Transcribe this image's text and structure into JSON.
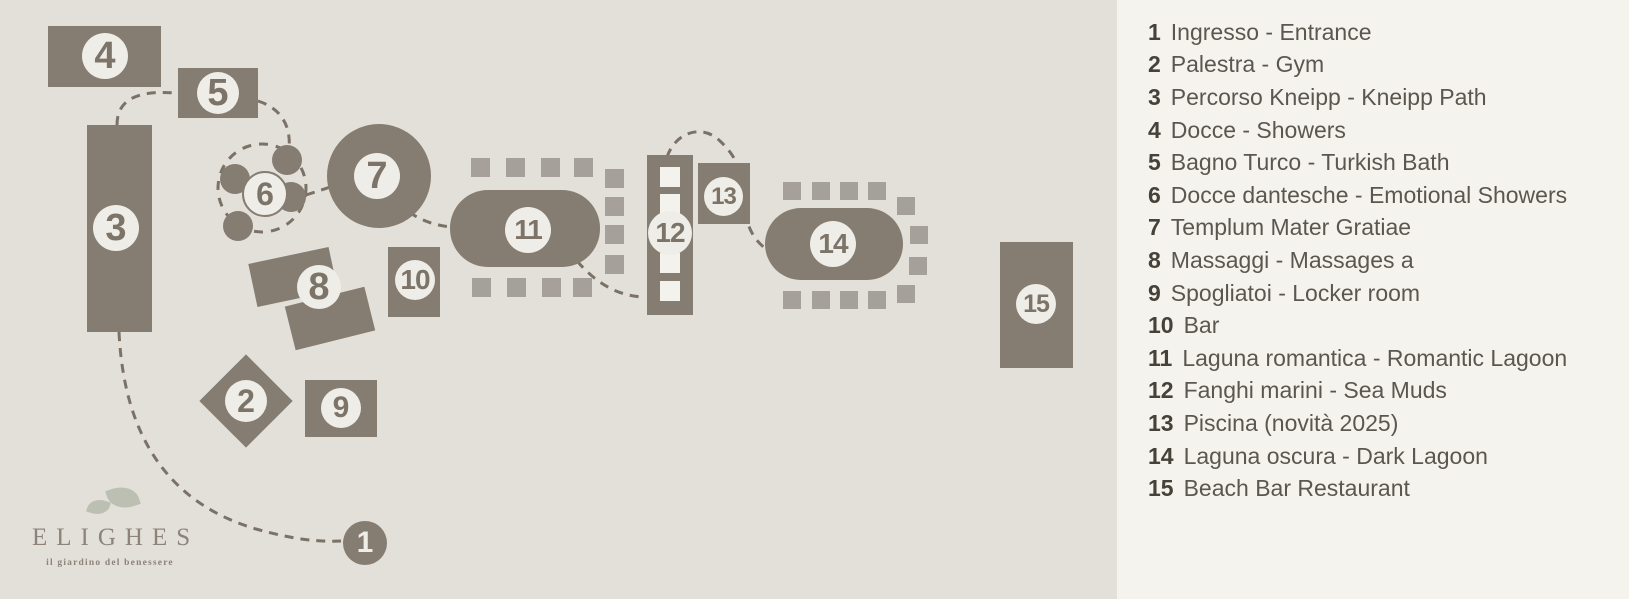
{
  "logo": {
    "brand": "ELIGHES",
    "tagline": "il giardino del benessere"
  },
  "map": {
    "markers": [
      "1",
      "2",
      "3",
      "4",
      "5",
      "6",
      "7",
      "8",
      "9",
      "10",
      "11",
      "12",
      "13",
      "14",
      "15"
    ]
  },
  "legend": {
    "items": [
      {
        "num": "1",
        "label": "Ingresso - Entrance"
      },
      {
        "num": "2",
        "label": "Palestra - Gym"
      },
      {
        "num": "3",
        "label": "Percorso Kneipp - Kneipp Path"
      },
      {
        "num": "4",
        "label": "Docce - Showers"
      },
      {
        "num": "5",
        "label": "Bagno Turco - Turkish Bath"
      },
      {
        "num": "6",
        "label": "Docce dantesche - Emotional Showers"
      },
      {
        "num": "7",
        "label": "Templum Mater Gratiae"
      },
      {
        "num": "8",
        "label": "Massaggi - Massages a"
      },
      {
        "num": "9",
        "label": "Spogliatoi - Locker room"
      },
      {
        "num": "10",
        "label": "Bar"
      },
      {
        "num": "11",
        "label": "Laguna romantica - Romantic Lagoon"
      },
      {
        "num": "12",
        "label": "Fanghi marini - Sea Muds"
      },
      {
        "num": "13",
        "label": "Piscina (novità 2025)"
      },
      {
        "num": "14",
        "label": "Laguna oscura - Dark Lagoon"
      },
      {
        "num": "15",
        "label": "Beach Bar Restaurant"
      }
    ]
  },
  "colors": {
    "shape": "#857c72",
    "map_background": "#e3e0da",
    "legend_background": "#f5f3ee",
    "dotted_square": "#a5a099",
    "badge_background": "#efede7",
    "dash_line": "#7b7166",
    "leaf": "#bcc0b3"
  }
}
